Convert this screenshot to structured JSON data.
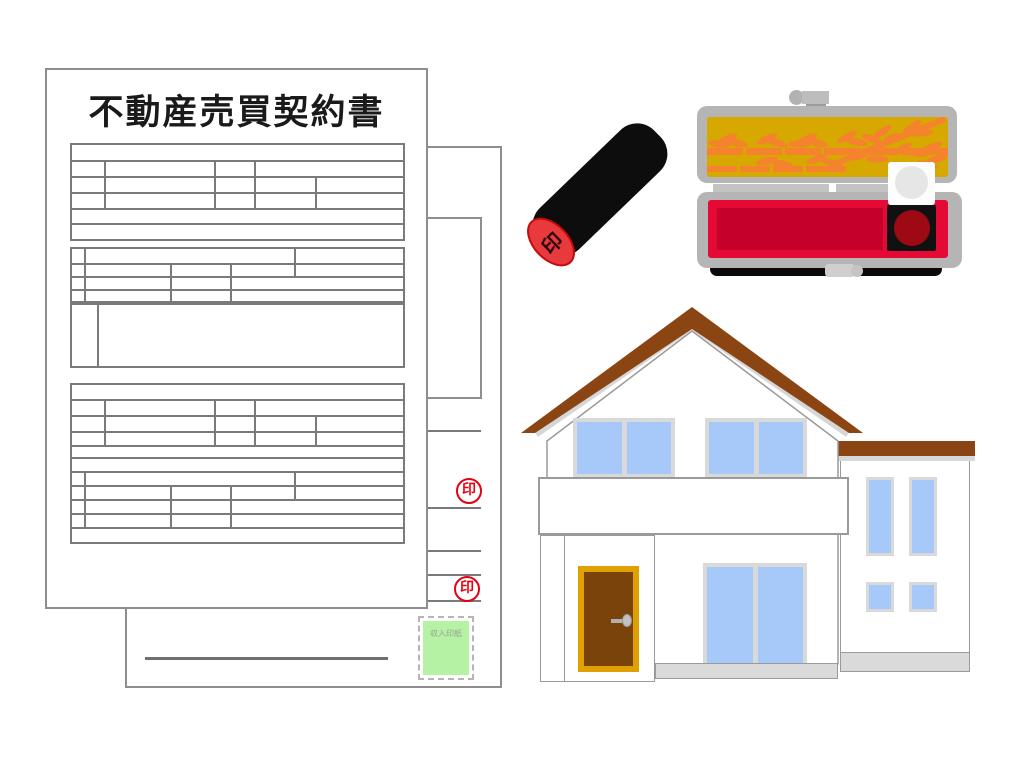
{
  "scene": {
    "type": "illustration",
    "background_color": "#ffffff",
    "subject": "Japanese real estate sales contract with personal seal (hanko), seal case with red ink pad, and a house"
  },
  "contract": {
    "title": "不動産売買契約書",
    "seal_mark": "印",
    "revenue_stamp_label": "収入印紙",
    "colors": {
      "paper": "#ffffff",
      "paper_border": "#8e8e8e",
      "table_line": "#7a7a7a",
      "seal_red": "#e60012",
      "revenue_stamp_green": "#b6f2a3"
    },
    "front_sheet_tables": [
      {
        "x": 70,
        "y": 143,
        "w": 335,
        "rows": [
          {
            "h": 15,
            "cols": [
              335
            ]
          },
          {
            "h": 16,
            "cols": [
              32,
              110,
              40,
              153
            ]
          },
          {
            "h": 16,
            "cols": [
              32,
              110,
              40,
              61,
              92
            ]
          },
          {
            "h": 16,
            "cols": [
              32,
              110,
              40,
              61,
              92
            ]
          },
          {
            "h": 15,
            "cols": [
              335
            ]
          },
          {
            "h": 16,
            "cols": [
              335
            ]
          }
        ]
      },
      {
        "x": 70,
        "y": 247,
        "w": 335,
        "rows": [
          {
            "h": 14,
            "cols": [
              12,
              210,
              113
            ]
          },
          {
            "h": 13,
            "cols": [
              12,
              86,
              60,
              64,
              113
            ]
          },
          {
            "h": 13,
            "cols": [
              12,
              86,
              60,
              177
            ]
          },
          {
            "h": 12,
            "cols": [
              12,
              86,
              60,
              177
            ]
          }
        ]
      },
      {
        "x": 70,
        "y": 303,
        "w": 335,
        "rows": [
          {
            "h": 61,
            "cols": [
              25,
              310
            ]
          }
        ]
      },
      {
        "x": 70,
        "y": 383,
        "w": 335,
        "rows": [
          {
            "h": 14,
            "cols": [
              335
            ]
          },
          {
            "h": 16,
            "cols": [
              32,
              110,
              40,
              153
            ]
          },
          {
            "h": 16,
            "cols": [
              32,
              110,
              40,
              61,
              92
            ]
          },
          {
            "h": 14,
            "cols": [
              32,
              110,
              40,
              61,
              92
            ]
          },
          {
            "h": 12,
            "cols": [
              335
            ]
          },
          {
            "h": 14,
            "cols": [
              335
            ]
          },
          {
            "h": 14,
            "cols": [
              12,
              210,
              113
            ]
          },
          {
            "h": 14,
            "cols": [
              12,
              86,
              60,
              64,
              113
            ]
          },
          {
            "h": 14,
            "cols": [
              12,
              86,
              60,
              177
            ]
          },
          {
            "h": 14,
            "cols": [
              12,
              86,
              60,
              177
            ]
          },
          {
            "h": 15,
            "cols": [
              335
            ]
          }
        ]
      }
    ]
  },
  "hanko": {
    "face_glyph": "印",
    "colors": {
      "body_black": "#0d0d0d",
      "face_red": "#e8393c",
      "face_ring": "#c40a0a"
    }
  },
  "seal_case": {
    "colors": {
      "case_gray": "#b5b5b5",
      "lid_gold": "#d6a800",
      "bamboo_orange": "#f5822d",
      "tray_red": "#e50a35",
      "tray_recess_red": "#c4002b",
      "ink_pad_red": "#9e0a13",
      "ink_pad_black": "#111111",
      "ink_pad_lid_white": "#fdfdfd"
    }
  },
  "house": {
    "colors": {
      "roof_brown": "#8b4513",
      "roof_trim_gray": "#d6d6d6",
      "wall_white": "#ffffff",
      "wall_outline": "#9a9a9a",
      "window_blue": "#a6c9fa",
      "window_frame": "#d9d9d9",
      "door_brown": "#7b430c",
      "door_frame_gold": "#dfa000",
      "foundation_gray": "#dadada"
    }
  }
}
